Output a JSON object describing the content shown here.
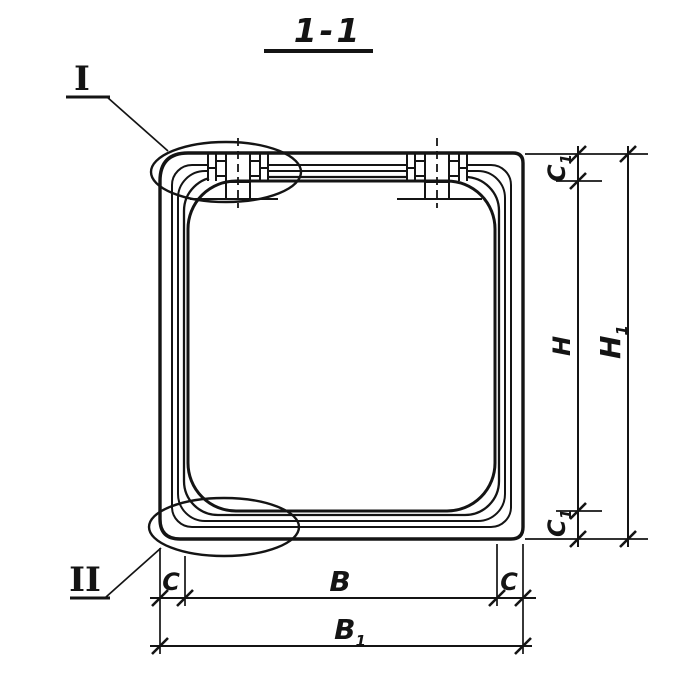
{
  "title": "1-1",
  "detail_callouts": {
    "one": "I",
    "two": "II"
  },
  "dims": {
    "c1_top": {
      "base": "C",
      "sub": "1"
    },
    "h": {
      "base": "H",
      "sub": ""
    },
    "h1": {
      "base": "H",
      "sub": "1"
    },
    "c1_bot": {
      "base": "C",
      "sub": "1"
    },
    "c_left": {
      "base": "C",
      "sub": ""
    },
    "b": {
      "base": "B",
      "sub": ""
    },
    "c_right": {
      "base": "C",
      "sub": ""
    },
    "b1": {
      "base": "B",
      "sub": "1"
    }
  },
  "colors": {
    "ink": "#141414",
    "paper": "#ffffff"
  }
}
